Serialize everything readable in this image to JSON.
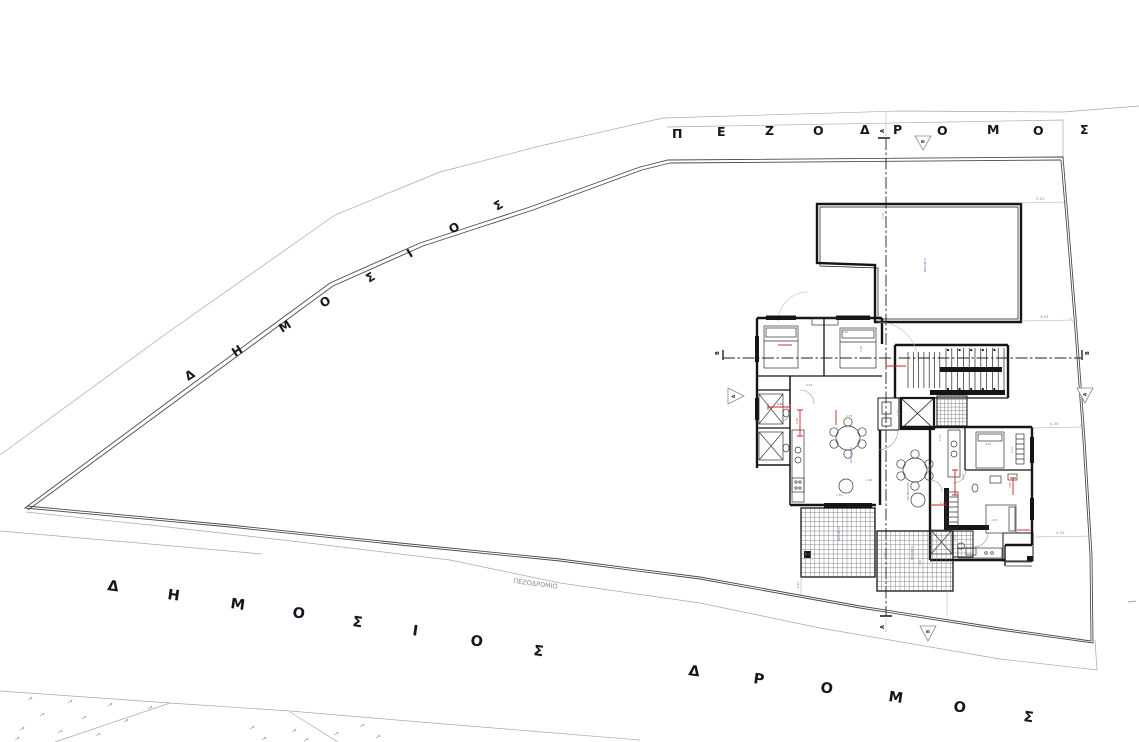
{
  "drawing": {
    "type": "architectural-site-plan",
    "roads": {
      "top": {
        "label": "ΠΕΖΟΔΡΟΜΟΣ"
      },
      "left": {
        "label": "ΔΗΜΟΣΙΟΣ"
      },
      "bottom_word1": {
        "label": "ΔΗΜΟΣΙΟΣ"
      },
      "bottom_word2": {
        "label": "ΔΡΟΜΟΣ"
      },
      "sidewalk": {
        "label": "ΠΕΖΟΔΡΟΜΙΟ"
      }
    },
    "section_markers": {
      "vertical_line_label": "Α",
      "vertical_triangle_label": "Β",
      "horizontal_line_label": "Β",
      "horizontal_triangle_label": "Α"
    },
    "boundary_dimensions": [
      "3.01",
      "3.03",
      "4.30",
      "4.20"
    ],
    "interior_dimensions": [
      "4.50",
      "1.35",
      "4.43",
      "2.35",
      "1.85",
      "1.20",
      "4.85",
      "1.70",
      "2.90",
      "3.95",
      "4.35",
      "1.10",
      "2.20",
      "3.40",
      "1.45",
      "5.01",
      "1.50",
      "4.28"
    ],
    "red_dimensions": [
      "0.90",
      "2.35",
      "1.75",
      "0.80"
    ],
    "room_labels": {
      "terrace": "ΒΕΡΑΝΤΑ",
      "living": "ΚΑΘΙΣΤΙΚΟ",
      "dining": "ΤΡΑΠΕΖΑΡΙΑ",
      "veranda_a": "ΒΕΡΑΝΤΑ",
      "veranda_b": "ΒΕΡΑΝΤΑ"
    },
    "colors": {
      "ink": "#151515",
      "boundary": "#4a4a4a",
      "road_gray": "#a8a8a8",
      "dim_gray": "#8a8a8a",
      "dim_blue": "#6b7fae",
      "dim_red": "#cc2020"
    }
  }
}
